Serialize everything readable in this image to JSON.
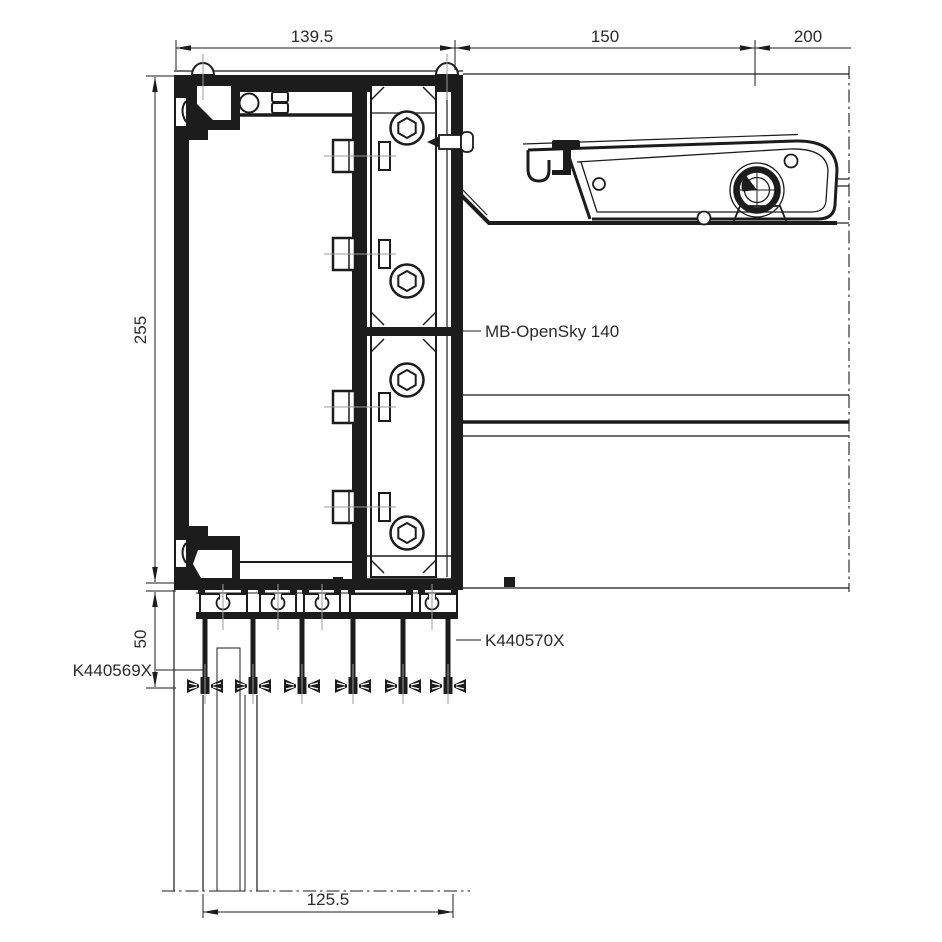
{
  "colors": {
    "line": "#1c1c1c",
    "centerline": "#9b9b9b",
    "glass_fill": "#d8d8d8",
    "glass_hatch": "#8f8f8f",
    "background": "#ffffff",
    "text": "#2b2b2b"
  },
  "dimensions": {
    "frame_width": "139.5",
    "roof_mid_span": "150",
    "roof_right_span": "200",
    "frame_height": "255",
    "lower_offset": "50",
    "glazing_width": "125.5"
  },
  "labels": {
    "system_name": "MB-OpenSky 140",
    "part_lower_profile": "K440570X",
    "part_gasket": "K440569X"
  }
}
